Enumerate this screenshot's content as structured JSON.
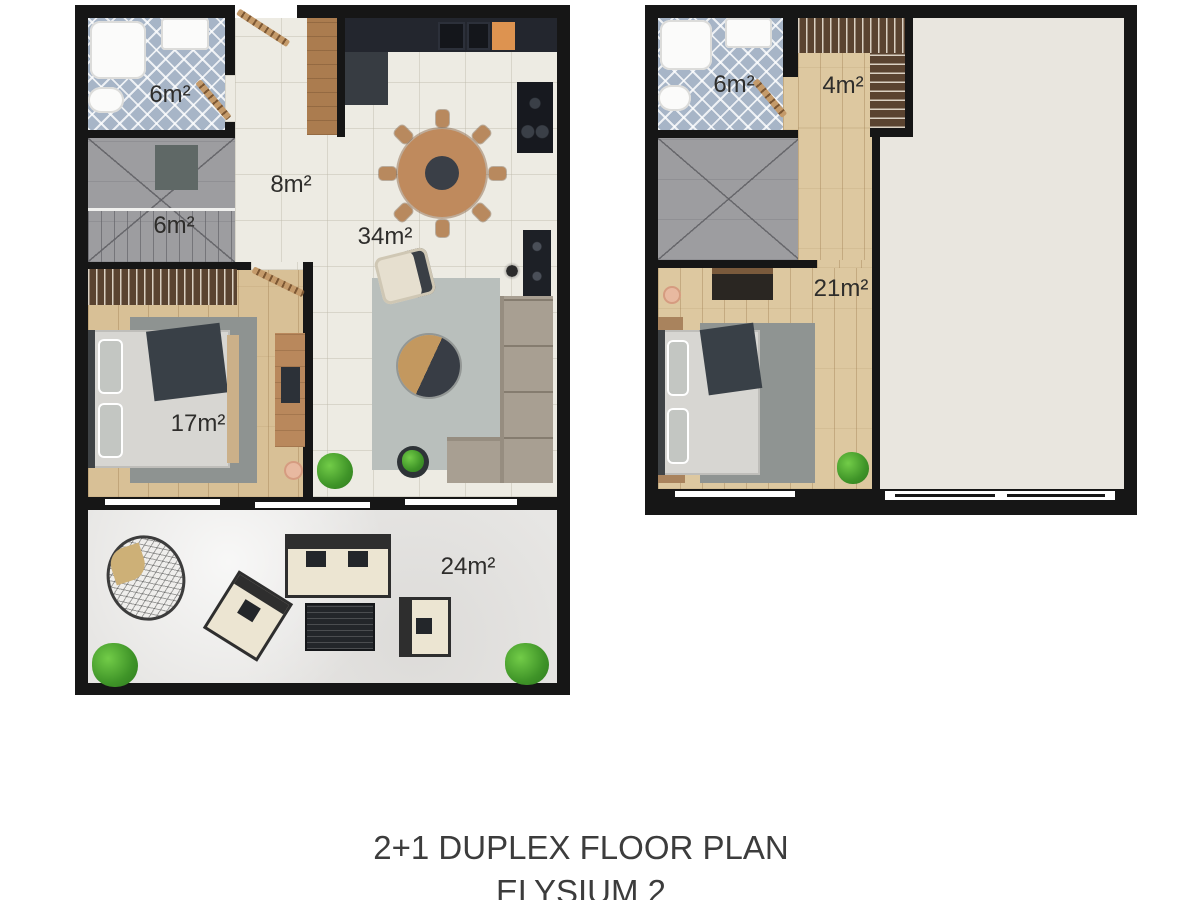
{
  "captions": {
    "title": "2+1 DUPLEX FLOOR PLAN",
    "subtitle": "ELYSIUM 2"
  },
  "colors": {
    "wall": "#161616",
    "cream_tile": "#edebe3",
    "bath_tile": "#a7b5c7",
    "wood_floor": "#d8c096",
    "stairs_gray": "#9d9da0",
    "terrace": "#e7e6e4",
    "void_area": "#e9e6df",
    "kitchen_counter": "#23262e",
    "cutting_board_orange": "#dd9350",
    "plant_green": "#3f9428"
  },
  "floor1": {
    "labels": {
      "bathroom": "6m²",
      "hall": "8m²",
      "stairs": "6m²",
      "living": "34m²",
      "bedroom": "17m²",
      "terrace": "24m²"
    }
  },
  "floor2": {
    "labels": {
      "bathroom": "6m²",
      "closet": "4m²",
      "bedroom": "21m²"
    }
  }
}
